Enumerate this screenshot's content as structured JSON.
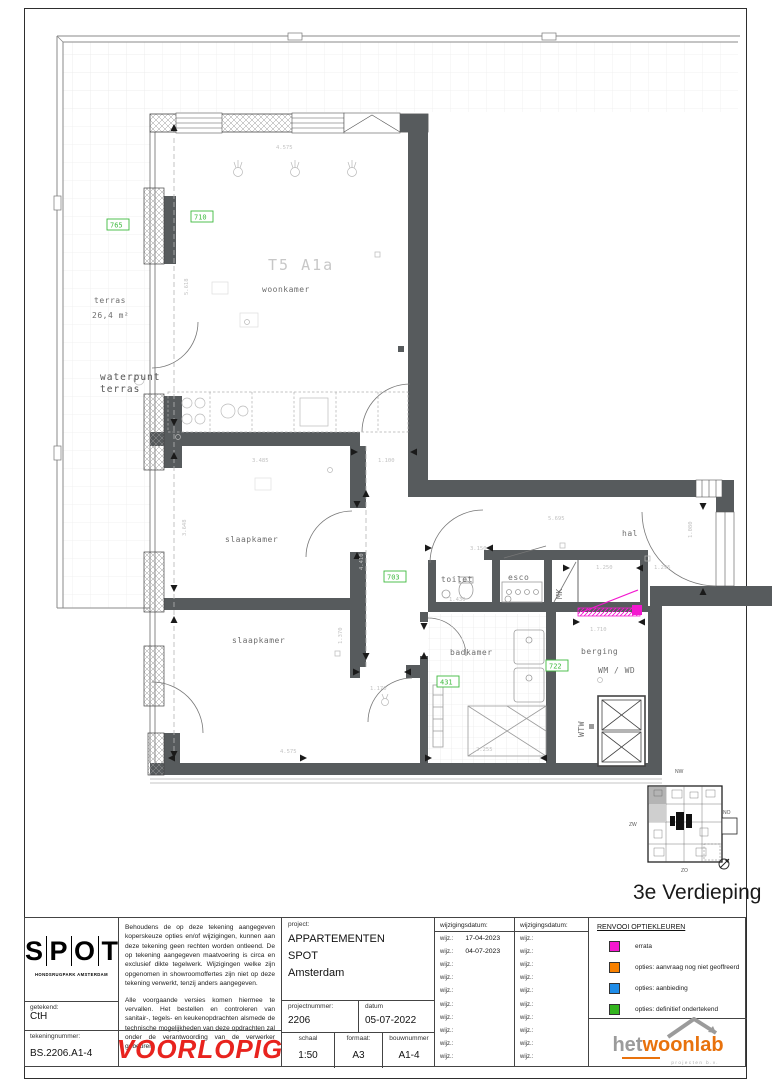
{
  "plan": {
    "type_label": "T5 A1a",
    "rooms": {
      "woonkamer": "woonkamer",
      "slaapkamer1": "slaapkamer",
      "slaapkamer2": "slaapkamer",
      "toilet": "toilet",
      "esco": "esco",
      "hal": "hal",
      "badkamer": "badkamer",
      "berging": "berging"
    },
    "labels": {
      "terras": "terras",
      "terras_area": "26,4 m²",
      "waterpunt_line1": "waterpunt",
      "waterpunt_line2": "terras",
      "mk": "MK",
      "wm_wd": "WM / WD",
      "wtw": "WTW"
    },
    "option_codes": {
      "c765": "765",
      "c710": "710",
      "c703": "703",
      "c431": "431",
      "c722": "722"
    },
    "dims": {
      "top_width": "4.575",
      "bedroom_width": "3.485",
      "corridor_width": "1.100",
      "hall_a": "3.150",
      "hall_b": "5.695",
      "hall_c": "1.250",
      "hall_d": "1.295",
      "entrance": "1.080",
      "berging_width": "1.710",
      "bath_width": "2.255",
      "bottom_width": "4.575",
      "toilet_depth": "1.430",
      "corridor_len": "4.410",
      "door_dim": "1.370",
      "lobby": "1.170",
      "kitchen_len": "5.618",
      "bedroom_len": "3.648"
    },
    "keyplan": {
      "nw": "NW",
      "zw": "ZW",
      "no": "NO",
      "zo": "ZO"
    },
    "floor_title": "3e Verdieping"
  },
  "titleblock": {
    "spot_letters": [
      "S",
      "P",
      "O",
      "T"
    ],
    "spot_subtitle": "HONDSRUGPARK AMSTERDAM",
    "getekend_label": "getekend:",
    "getekend_value": "CtH",
    "tekeningnummer_label": "tekeningnummer:",
    "tekeningnummer_value": "BS.2206.A1-4",
    "disclaimer_p1": "Behoudens de op deze tekening aangegeven koperskeuze opties en/of wijzigingen, kunnen aan deze tekening geen rechten worden ontleend. De op tekening aangegeven maatvoering is circa en exclusief dikte tegelwerk. Wijzigingen welke zijn opgenomen in showroomoffertes zijn niet op deze tekening verwerkt, tenzij anders aangegeven.",
    "disclaimer_p2": "Alle voorgaande versies komen hiermee te vervallen. Het bestellen en controleren van sanitair-, tegels- en keukenopdrachten alsmede de technische mogelijkheden van deze opdrachten zal onder de verantwoording van de verwerker gebeuren.",
    "stamp": "VOORLOPIG",
    "project_label": "project:",
    "project_lines": [
      "APPARTEMENTEN",
      "SPOT",
      "Amsterdam"
    ],
    "projectnummer_label": "projectnummer:",
    "projectnummer_value": "2206",
    "datum_label": "datum",
    "datum_value": "05-07-2022",
    "schaal_label": "schaal",
    "schaal_value": "1:50",
    "formaat_label": "formaat:",
    "formaat_value": "A3",
    "bouwnummer_label": "bouwnummer",
    "bouwnummer_value": "A1-4",
    "wijzigingsdatum_label": "wijzigingsdatum:",
    "wijz_label": "wijz.:",
    "wijz_col1": [
      "17-04-2023",
      "04-07-2023",
      "",
      "",
      "",
      "",
      "",
      "",
      "",
      ""
    ],
    "wijz_col2": [
      "",
      "",
      "",
      "",
      "",
      "",
      "",
      "",
      "",
      ""
    ],
    "legend": {
      "title": "RENVOOI OPTIEKLEUREN",
      "items": [
        {
          "color": "#f318cf",
          "label": "errata"
        },
        {
          "color": "#f88000",
          "label": "opties: aanvraag nog niet geoffreerd"
        },
        {
          "color": "#1e8ce8",
          "label": "opties: aanbieding"
        },
        {
          "color": "#33b51e",
          "label": "opties: definitief ondertekend"
        }
      ]
    },
    "woonlab": {
      "part1": "het",
      "part2": "woonlab",
      "subtitle": "projecten b.v."
    }
  }
}
